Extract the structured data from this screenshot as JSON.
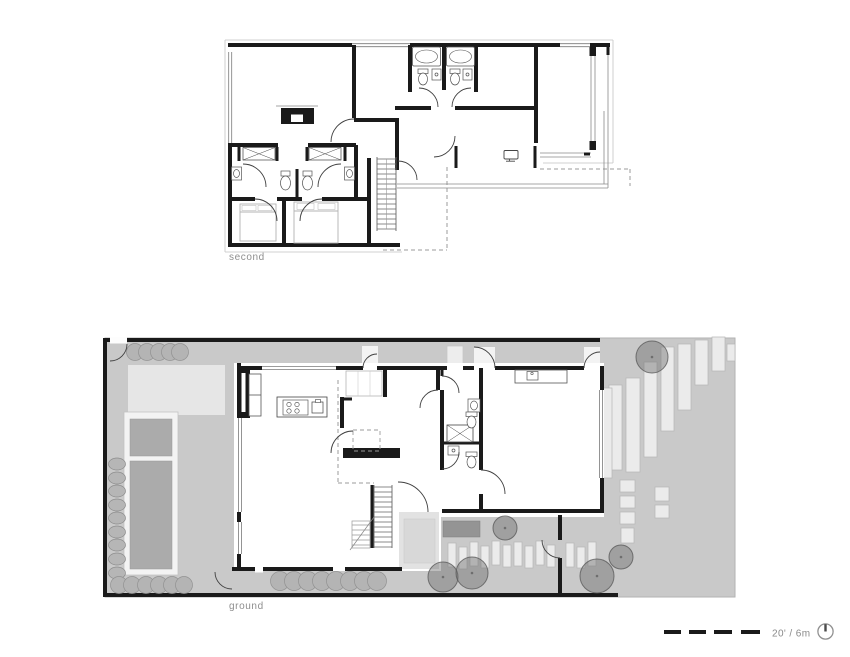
{
  "plans": {
    "second": {
      "label": "second"
    },
    "ground": {
      "label": "ground"
    }
  },
  "scale_bar": {
    "label": "20' / 6m",
    "dash_count": 4,
    "north_icon": "north-arrow-icon"
  },
  "colors": {
    "wall_black": "#1a1a1a",
    "site_gray": "#c9c9c9",
    "deck_light_gray": "#e6e6e6",
    "pool_water_gray": "#ababab",
    "tree_gray": "#8f8f8f",
    "paver_light": "#ebebeb",
    "label_gray": "#8e8e8e",
    "dashed_line_gray": "#9b9b9b"
  }
}
